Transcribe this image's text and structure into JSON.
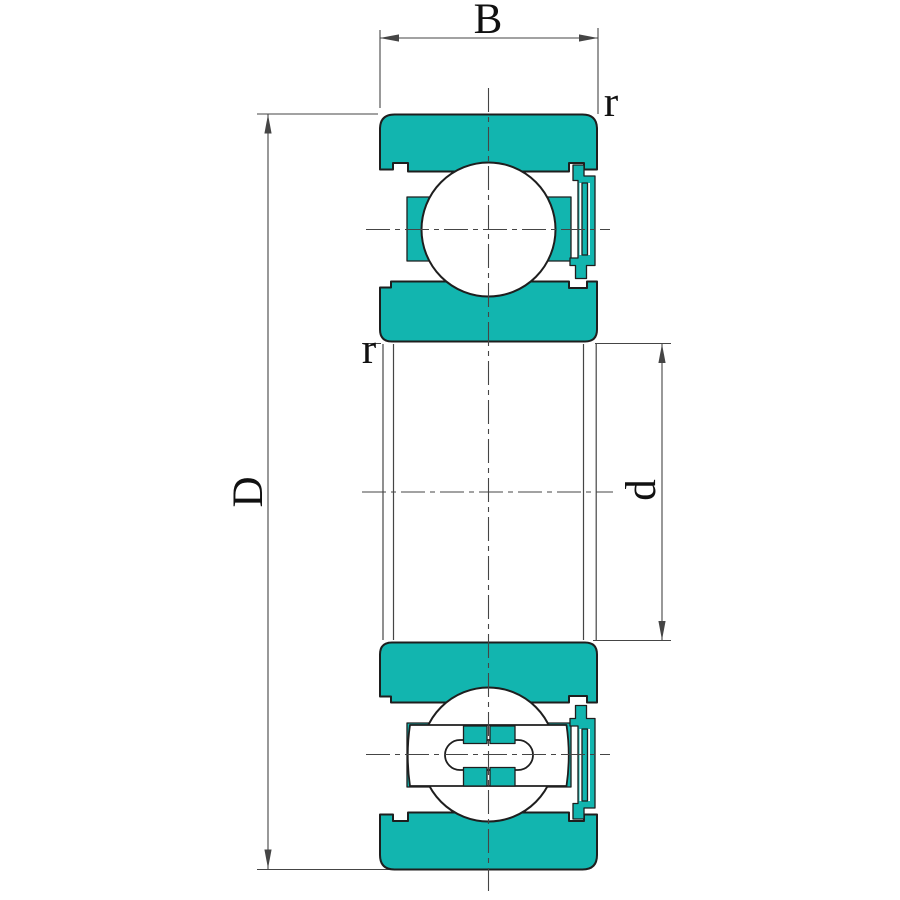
{
  "figure": {
    "kind": "ball-bearing-cross-section-drawing",
    "labels": {
      "width": "B",
      "outer_diameter": "D",
      "bore_diameter": "d",
      "outer_corner_radius": "r",
      "inner_corner_radius": "r"
    },
    "colors": {
      "ring_fill": "#12b5af",
      "outline": "#1e1e1e",
      "thin_line": "#454545",
      "background": "#ffffff",
      "label": "#111111"
    }
  }
}
